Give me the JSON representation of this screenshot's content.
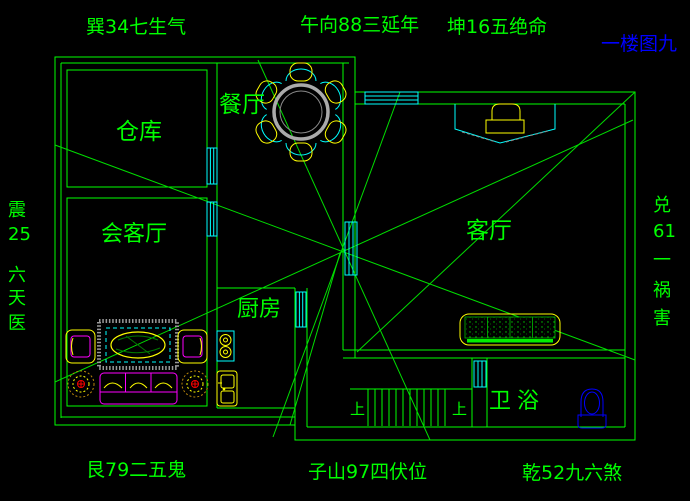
{
  "title": "一楼图九",
  "compass_labels": {
    "top": [
      "巽34七生气",
      "午向88三延年",
      "坤16五绝命"
    ],
    "bottom": [
      "艮79二五鬼",
      "子山97四伏位",
      "乾52九六煞"
    ],
    "left": [
      "震",
      "25",
      "六",
      "天",
      "医"
    ],
    "right": [
      "兑",
      "61",
      "一",
      "祸",
      "害"
    ]
  },
  "rooms": {
    "storage": "仓库",
    "dining": "餐厅",
    "meeting": "会客厅",
    "kitchen": "厨房",
    "living": "客厅",
    "bath": "卫浴"
  },
  "stairs": {
    "up_left": "上",
    "up_right": "上"
  },
  "colors": {
    "background": "#000000",
    "walls_and_text": "#00ff00",
    "doors_windows": "#00ffff",
    "furniture_primary": "#ffff00",
    "furniture_secondary": "#ff00ff",
    "sanitary_and_title": "#0000ff",
    "table_gray": "#a9a9a9",
    "accent_red": "#ff0000"
  }
}
